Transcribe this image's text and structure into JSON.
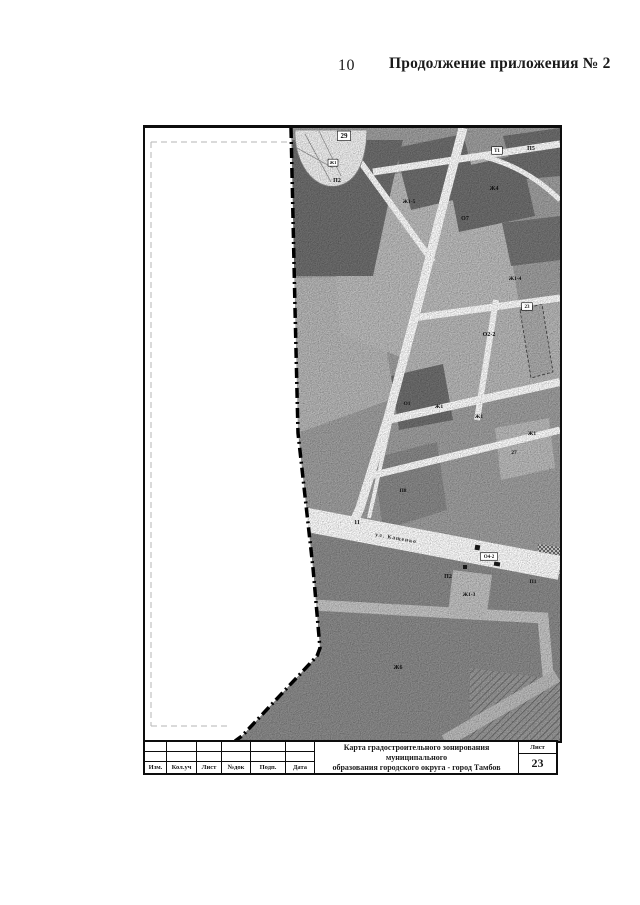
{
  "page": {
    "number": "10",
    "header_title": "Продолжение приложения № 2"
  },
  "map": {
    "street_label": "ул. Кащенко",
    "zone_labels": [
      {
        "text": "29",
        "x": 199,
        "y": 10,
        "boxed": true,
        "size": 7
      },
      {
        "text": "Ж1",
        "x": 188,
        "y": 36,
        "boxed": true,
        "size": 4.5
      },
      {
        "text": "П2",
        "x": 192,
        "y": 54,
        "size": 6
      },
      {
        "text": "Ж1-5",
        "x": 264,
        "y": 75,
        "size": 5.5
      },
      {
        "text": "Т1",
        "x": 352,
        "y": 24,
        "boxed": true,
        "size": 5
      },
      {
        "text": "П5",
        "x": 386,
        "y": 22,
        "size": 6
      },
      {
        "text": "Ж4",
        "x": 349,
        "y": 62,
        "size": 6
      },
      {
        "text": "О7",
        "x": 320,
        "y": 92,
        "size": 6
      },
      {
        "text": "Ж1-4",
        "x": 370,
        "y": 152,
        "size": 5.5
      },
      {
        "text": "23",
        "x": 382,
        "y": 180,
        "boxed": true,
        "size": 5
      },
      {
        "text": "О2-2",
        "x": 344,
        "y": 208,
        "size": 6
      },
      {
        "text": "Ж1",
        "x": 294,
        "y": 280,
        "size": 5.5
      },
      {
        "text": "Ж1",
        "x": 334,
        "y": 290,
        "size": 5.5
      },
      {
        "text": "Ж1",
        "x": 387,
        "y": 307,
        "size": 5.5
      },
      {
        "text": "27",
        "x": 369,
        "y": 326,
        "size": 5.5
      },
      {
        "text": "О1",
        "x": 262,
        "y": 277,
        "size": 5.5
      },
      {
        "text": "П8",
        "x": 258,
        "y": 364,
        "size": 5.5
      },
      {
        "text": "11",
        "x": 212,
        "y": 396,
        "size": 6
      },
      {
        "text": "О4-2",
        "x": 344,
        "y": 430,
        "boxed": true,
        "size": 5
      },
      {
        "text": "П2",
        "x": 303,
        "y": 450,
        "size": 6
      },
      {
        "text": "Ж1-3",
        "x": 324,
        "y": 468,
        "size": 5.5
      },
      {
        "text": "П1",
        "x": 388,
        "y": 455,
        "size": 5.5
      },
      {
        "text": "Ж6",
        "x": 253,
        "y": 541,
        "size": 6
      }
    ],
    "colors": {
      "base": "#a0a0a0",
      "light": "#bdbdbd",
      "dark": "#6f6f6f",
      "bottom_zone": "#8c8c8c",
      "road": "#ffffff",
      "boundary": "#000000"
    }
  },
  "title_block": {
    "columns": [
      "Изм.",
      "Кол.уч",
      "Лист",
      "№док",
      "Подп.",
      "Дата"
    ],
    "title_line1": "Карта градостроительного зонирования муниципального",
    "title_line2": "образования городского округа - город Тамбов",
    "sheet_label": "Лист",
    "sheet_number": "23"
  }
}
